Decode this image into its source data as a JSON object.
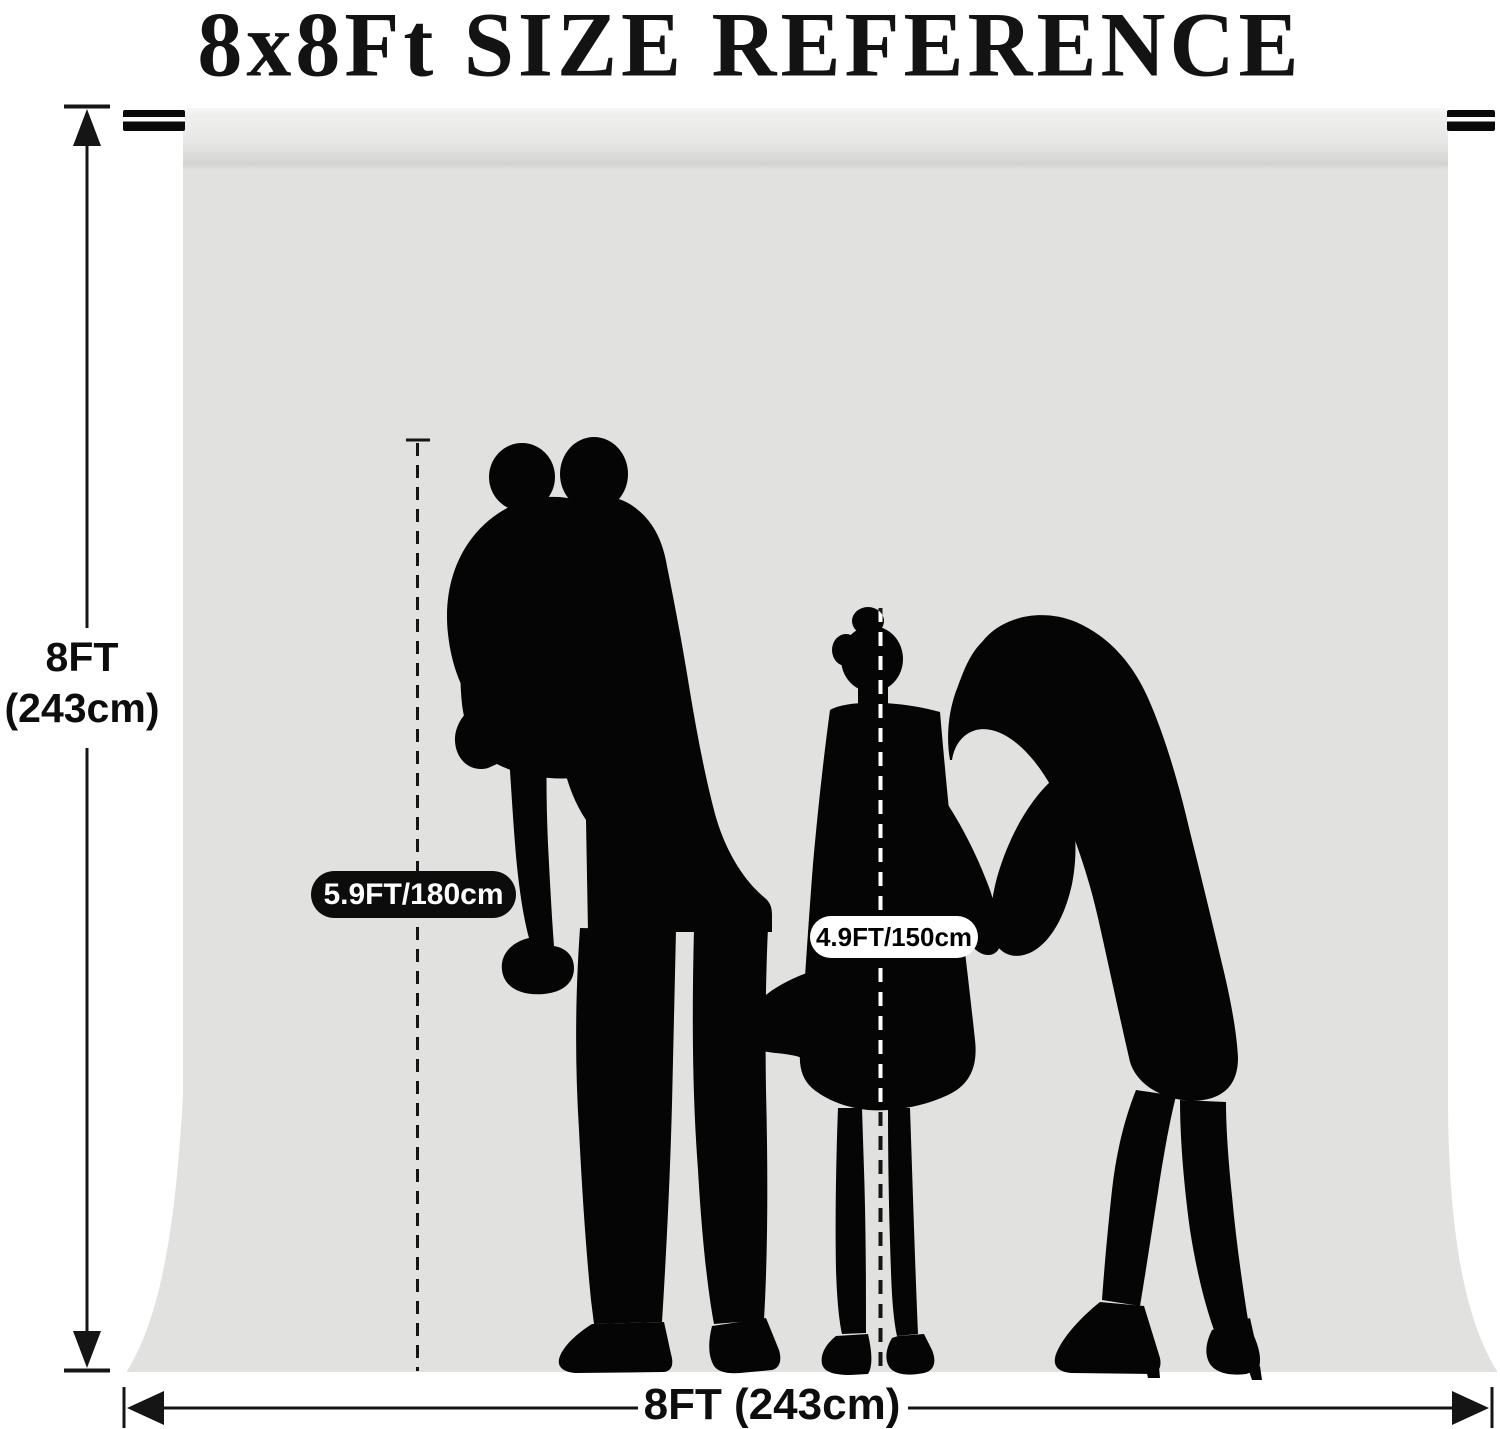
{
  "title": "8x8Ft SIZE REFERENCE",
  "backdrop": {
    "height_label": {
      "line1": "8FT",
      "line2": "(243cm)"
    },
    "width_label": "8FT (243cm)",
    "adult_height_badge": "5.9FT/180cm",
    "child_height_badge": "4.9FT/150cm"
  },
  "colors": {
    "page_bg": "#ffffff",
    "backdrop_fabric": "#e1e1e0",
    "backdrop_crease": "#d3d3d1",
    "silhouette": "#050505",
    "dimension_line": "#151515",
    "adult_badge_bg": "#0c0c0c",
    "adult_badge_text": "#ffffff",
    "child_badge_bg": "#ffffff",
    "child_badge_text": "#000000"
  }
}
